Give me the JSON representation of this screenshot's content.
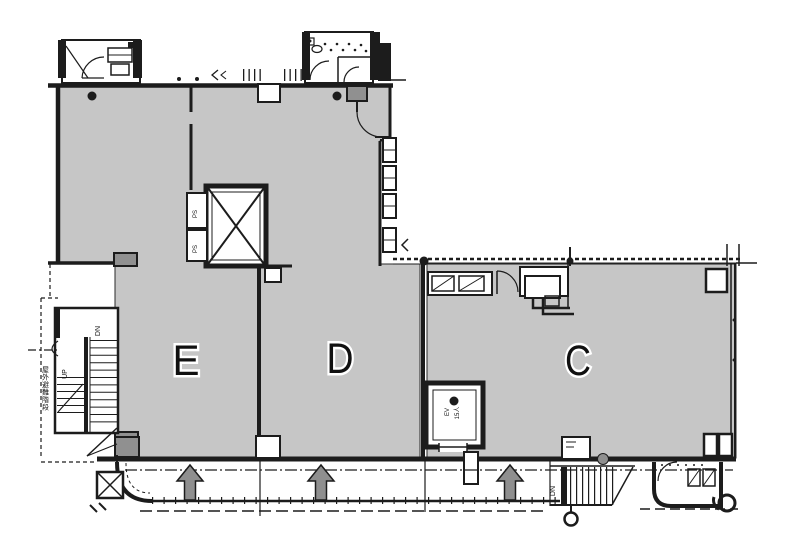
{
  "colors": {
    "floor-fill": "#c6c6c6",
    "wall-color": "#1c1c1c",
    "column-fill": "#909090",
    "arrow-fill": "#8f8f8f",
    "label-halo": "#ffffff"
  },
  "units": [
    {
      "label": "E"
    },
    {
      "label": "D"
    },
    {
      "label": "C"
    }
  ],
  "labels": {
    "elevator": "EV",
    "elevator_capacity": "15人",
    "pipe_shaft": "PS",
    "stair_up": "UP",
    "stair_down": "DN",
    "exterior_stair_down": "DN",
    "evacuation_stair": "屋外避難階段"
  },
  "symbols": {
    "entry_arrow_count": 3
  }
}
